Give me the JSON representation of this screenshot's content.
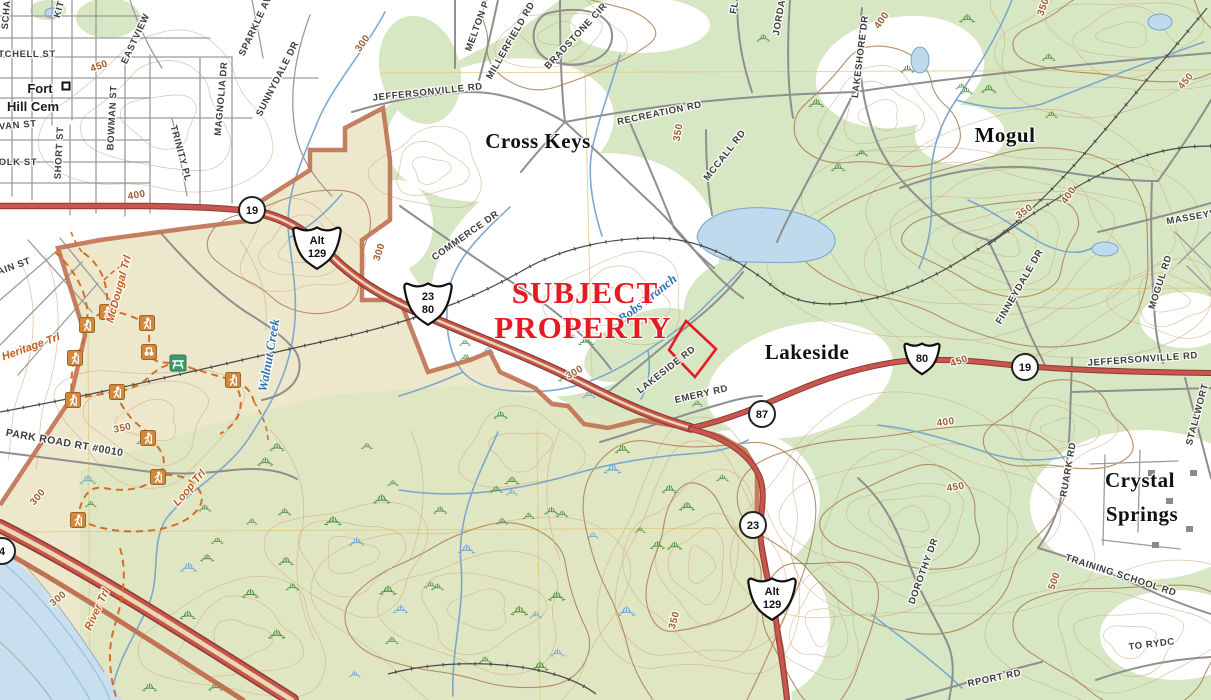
{
  "map_name": "usgs-topo-subject-property-exhibit",
  "subject": {
    "line1": "SUBJECT",
    "line2": "PROPERTY"
  },
  "labels": [
    {
      "t": "SCHA",
      "x": 9,
      "y": 15,
      "r": -85,
      "c": "st"
    },
    {
      "t": "KIT",
      "x": 62,
      "y": 10,
      "r": -75,
      "c": "st"
    },
    {
      "t": "TCHELL ST",
      "x": 27,
      "y": 57,
      "r": 0,
      "c": "st"
    },
    {
      "t": "VAN ST",
      "x": 18,
      "y": 128,
      "r": -5,
      "c": "st"
    },
    {
      "t": "OLK ST",
      "x": 18,
      "y": 165,
      "r": 0,
      "c": "st"
    },
    {
      "t": "SHORT ST",
      "x": 62,
      "y": 153,
      "r": -87,
      "c": "st"
    },
    {
      "t": "BOWMAN ST",
      "x": 115,
      "y": 118,
      "r": -87,
      "c": "st"
    },
    {
      "t": "TRINITY PL",
      "x": 178,
      "y": 154,
      "r": 75,
      "c": "st"
    },
    {
      "t": "MAGNOLIA DR",
      "x": 224,
      "y": 99,
      "r": -85,
      "c": "st"
    },
    {
      "t": "SUNNYDALE DR",
      "x": 280,
      "y": 80,
      "r": -63,
      "c": "st"
    },
    {
      "t": "SPARKLE AV",
      "x": 258,
      "y": 27,
      "r": -65,
      "c": "st"
    },
    {
      "t": "EASTVIEW",
      "x": 138,
      "y": 40,
      "r": -65,
      "c": "st"
    },
    {
      "t": "AIN ST",
      "x": 15,
      "y": 269,
      "r": -20,
      "c": "st"
    },
    {
      "t": "JEFFERSONVILLE RD",
      "x": 428,
      "y": 95,
      "r": -6,
      "c": "st"
    },
    {
      "t": "MELTON P",
      "x": 480,
      "y": 27,
      "r": -70,
      "c": "st"
    },
    {
      "t": "MILLERFIELD RD",
      "x": 513,
      "y": 42,
      "r": -60,
      "c": "st"
    },
    {
      "t": "BRADSTONE CIR",
      "x": 578,
      "y": 38,
      "r": -47,
      "c": "st"
    },
    {
      "t": "RECREATION RD",
      "x": 660,
      "y": 116,
      "r": -12,
      "c": "st"
    },
    {
      "t": "MCCALL RD",
      "x": 727,
      "y": 157,
      "r": -52,
      "c": "st"
    },
    {
      "t": "FL",
      "x": 737,
      "y": 8,
      "r": -80,
      "c": "st"
    },
    {
      "t": "JORDA",
      "x": 782,
      "y": 18,
      "r": -80,
      "c": "st"
    },
    {
      "t": "LAKESHORE DR",
      "x": 863,
      "y": 57,
      "r": -83,
      "c": "st"
    },
    {
      "t": "MASSEYV",
      "x": 1192,
      "y": 220,
      "r": -10,
      "c": "st"
    },
    {
      "t": "MOGUL RD",
      "x": 1163,
      "y": 283,
      "r": -72,
      "c": "st"
    },
    {
      "t": "FINNEYDALE DR",
      "x": 1022,
      "y": 288,
      "r": -60,
      "c": "st"
    },
    {
      "t": "COMMERCE DR",
      "x": 467,
      "y": 238,
      "r": -35,
      "c": "st"
    },
    {
      "t": "LAKESIDE RD",
      "x": 668,
      "y": 372,
      "r": -38,
      "c": "st"
    },
    {
      "t": "EMERY RD",
      "x": 702,
      "y": 397,
      "r": -13,
      "c": "st"
    },
    {
      "t": "JEFFERSONVILLE RD",
      "x": 1143,
      "y": 362,
      "r": -4,
      "c": "st"
    },
    {
      "t": "STALLWORT",
      "x": 1200,
      "y": 415,
      "r": -75,
      "c": "st"
    },
    {
      "t": "RUARK RD",
      "x": 1071,
      "y": 470,
      "r": -80,
      "c": "st"
    },
    {
      "t": "TRAINING SCHOOL RD",
      "x": 1120,
      "y": 578,
      "r": 18,
      "c": "st"
    },
    {
      "t": "TO RYDC",
      "x": 1152,
      "y": 647,
      "r": -7,
      "c": "st"
    },
    {
      "t": "DOROTHY DR",
      "x": 926,
      "y": 572,
      "r": -70,
      "c": "st"
    },
    {
      "t": "RPORT RD",
      "x": 995,
      "y": 681,
      "r": -12,
      "c": "st"
    },
    {
      "t": "Cross Keys",
      "x": 538,
      "y": 148,
      "r": 0,
      "c": "pl"
    },
    {
      "t": "Mogul",
      "x": 1005,
      "y": 142,
      "r": 0,
      "c": "pl"
    },
    {
      "t": "Lakeside",
      "x": 807,
      "y": 359,
      "r": 0,
      "c": "pl"
    },
    {
      "t": "Crystal",
      "x": 1140,
      "y": 487,
      "r": 0,
      "c": "pl"
    },
    {
      "t": "Springs",
      "x": 1142,
      "y": 521,
      "r": 0,
      "c": "pl"
    },
    {
      "t": "Fort",
      "x": 40,
      "y": 93,
      "r": 0,
      "c": "md"
    },
    {
      "t": "Hill Cem",
      "x": 33,
      "y": 111,
      "r": 0,
      "c": "md"
    },
    {
      "t": "450",
      "x": 100,
      "y": 69,
      "r": -20,
      "c": "ct"
    },
    {
      "t": "400",
      "x": 137,
      "y": 198,
      "r": -10,
      "c": "ct"
    },
    {
      "t": "300",
      "x": 365,
      "y": 45,
      "r": -55,
      "c": "ct"
    },
    {
      "t": "350",
      "x": 681,
      "y": 133,
      "r": -80,
      "c": "ct"
    },
    {
      "t": "400",
      "x": 884,
      "y": 22,
      "r": -55,
      "c": "ct"
    },
    {
      "t": "450",
      "x": 1188,
      "y": 83,
      "r": -50,
      "c": "ct"
    },
    {
      "t": "350",
      "x": 1046,
      "y": 8,
      "r": -70,
      "c": "ct"
    },
    {
      "t": "350",
      "x": 1026,
      "y": 214,
      "r": -35,
      "c": "ct"
    },
    {
      "t": "400",
      "x": 1071,
      "y": 197,
      "r": -55,
      "c": "ct"
    },
    {
      "t": "300",
      "x": 382,
      "y": 253,
      "r": -72,
      "c": "ct"
    },
    {
      "t": "350",
      "x": 123,
      "y": 431,
      "r": -12,
      "c": "ct"
    },
    {
      "t": "300",
      "x": 40,
      "y": 499,
      "r": -50,
      "c": "ct"
    },
    {
      "t": "300",
      "x": 60,
      "y": 601,
      "r": -40,
      "c": "ct"
    },
    {
      "t": "300",
      "x": 576,
      "y": 375,
      "r": -30,
      "c": "ct"
    },
    {
      "t": "350",
      "x": 677,
      "y": 621,
      "r": -75,
      "c": "ct"
    },
    {
      "t": "450",
      "x": 960,
      "y": 364,
      "r": -20,
      "c": "ct"
    },
    {
      "t": "400",
      "x": 946,
      "y": 425,
      "r": -8,
      "c": "ct"
    },
    {
      "t": "450",
      "x": 956,
      "y": 490,
      "r": -10,
      "c": "ct"
    },
    {
      "t": "500",
      "x": 1057,
      "y": 582,
      "r": -70,
      "c": "ct"
    },
    {
      "t": "Walnut Creek",
      "x": 273,
      "y": 356,
      "r": -80,
      "c": "wt"
    },
    {
      "t": "Bobs Branch",
      "x": 650,
      "y": 302,
      "r": -38,
      "c": "wt"
    },
    {
      "t": "Heritage Trl",
      "x": 32,
      "y": 350,
      "r": -20,
      "c": "tr"
    },
    {
      "t": "McDougal Trl",
      "x": 122,
      "y": 290,
      "r": -75,
      "c": "tr"
    },
    {
      "t": "Loop Trl",
      "x": 192,
      "y": 490,
      "r": -50,
      "c": "tr"
    },
    {
      "t": "River Trl",
      "x": 100,
      "y": 611,
      "r": -65,
      "c": "tr"
    },
    {
      "t": "PARK ROAD RT #0010",
      "x": 64,
      "y": 446,
      "r": 10,
      "c": "pr"
    }
  ],
  "shields": [
    {
      "shape": "circle",
      "lines": [
        "19"
      ],
      "x": 252,
      "y": 210
    },
    {
      "shape": "us",
      "lines": [
        "Alt",
        "129"
      ],
      "x": 317,
      "y": 247
    },
    {
      "shape": "us",
      "lines": [
        "23",
        "80"
      ],
      "x": 428,
      "y": 303
    },
    {
      "shape": "circle",
      "lines": [
        "87"
      ],
      "x": 762,
      "y": 414
    },
    {
      "shape": "us",
      "lines": [
        "80"
      ],
      "x": 922,
      "y": 358
    },
    {
      "shape": "circle",
      "lines": [
        "19"
      ],
      "x": 1025,
      "y": 367
    },
    {
      "shape": "circle",
      "lines": [
        "23"
      ],
      "x": 753,
      "y": 525
    },
    {
      "shape": "us",
      "lines": [
        "Alt",
        "129"
      ],
      "x": 772,
      "y": 598
    },
    {
      "shape": "circle",
      "lines": [
        "4"
      ],
      "x": 2,
      "y": 551
    }
  ],
  "icons": {
    "hikers": [
      [
        107,
        312
      ],
      [
        87,
        325
      ],
      [
        147,
        323
      ],
      [
        75,
        358
      ],
      [
        117,
        392
      ],
      [
        73,
        400
      ],
      [
        233,
        380
      ],
      [
        148,
        438
      ],
      [
        158,
        477
      ],
      [
        78,
        520
      ]
    ],
    "binoculars": [
      [
        149,
        352
      ]
    ],
    "picnic": [
      [
        178,
        363
      ]
    ],
    "cemetery": [
      [
        66,
        86
      ]
    ]
  },
  "colors": {
    "woodland": "#D7E7C4",
    "park_tan": "#EDE8CC",
    "water_line": "#76A5CE",
    "water_fill": "#BFDAEC",
    "highway_red": "#C9564E",
    "boundary_brown": "#C07455",
    "trail_orange": "#D2691E",
    "contour": "#CDAA7D",
    "contour_index": "#AA7C4F",
    "subject_red": "#E51A23",
    "railroad": "#4A4A4A",
    "road_gray": "#8F8F8F"
  }
}
